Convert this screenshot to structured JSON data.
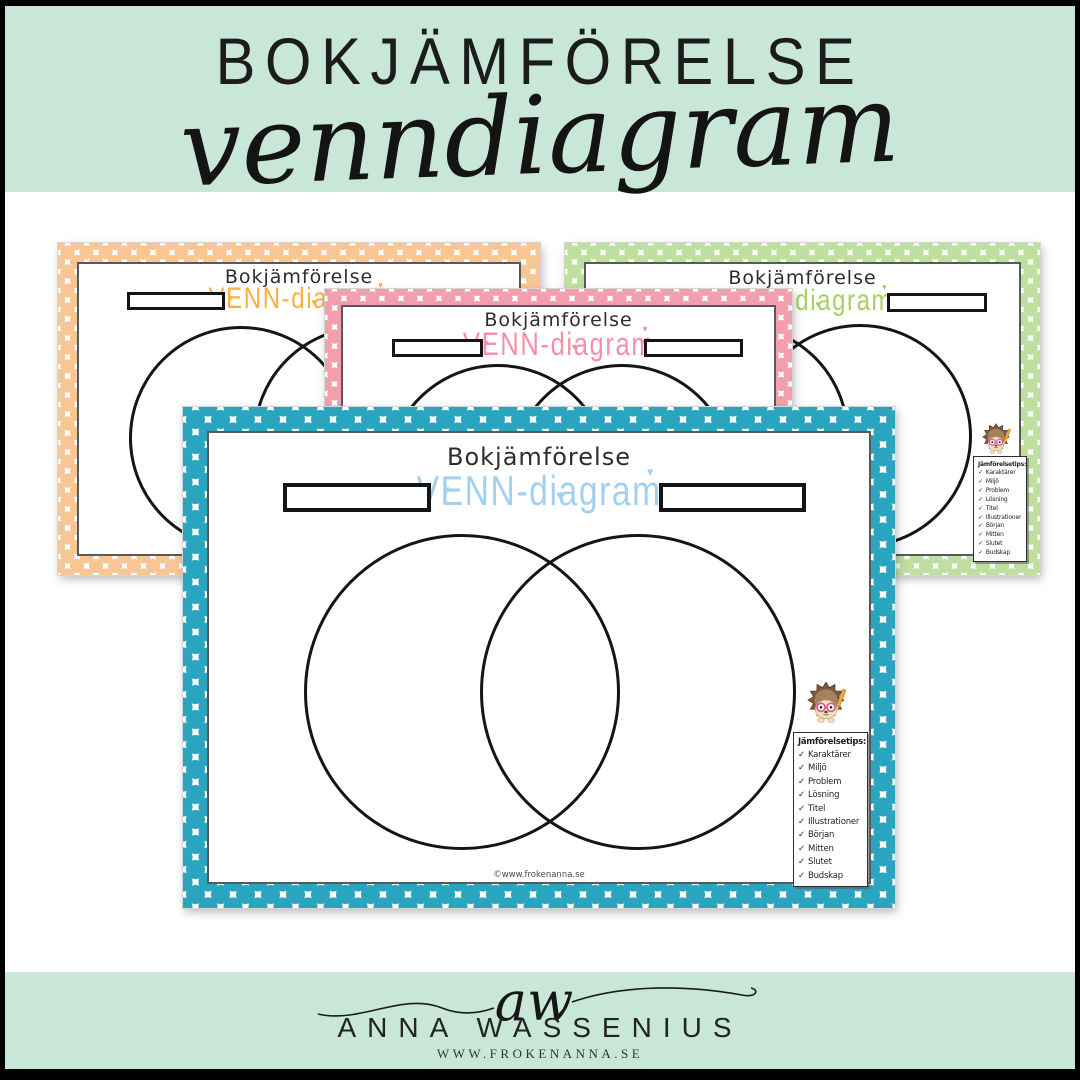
{
  "header": {
    "title": "BOKJÄMFÖRELSE",
    "subtitle": "venndiagram"
  },
  "worksheet": {
    "title": "Bokjämförelse",
    "subtitle": "VENN-diagram",
    "watermark": "©www.frokenanna.se",
    "tips": {
      "title": "Jämförelsetips:",
      "items": [
        "Karaktärer",
        "Miljö",
        "Problem",
        "Lösning",
        "Titel",
        "Illustrationer",
        "Början",
        "Mitten",
        "Slutet",
        "Budskap"
      ]
    }
  },
  "footer": {
    "monogram": "aw",
    "name": "ANNA WASSENIUS",
    "website": "WWW.FROKENANNA.SE"
  },
  "icons": {
    "heart": "♥",
    "check": "✓"
  },
  "colors": {
    "mint_band": "#C9E7D9",
    "teal_dots": "#2AA5BF",
    "orange_dots": "#F8C695",
    "pink_dots": "#F29FAB",
    "green_dots": "#BFDFA0",
    "venn_blue_text": "#A3D0EE",
    "venn_orange_text": "#FBB040",
    "venn_pink_text": "#F590A8",
    "venn_green_text": "#A9CE62"
  }
}
